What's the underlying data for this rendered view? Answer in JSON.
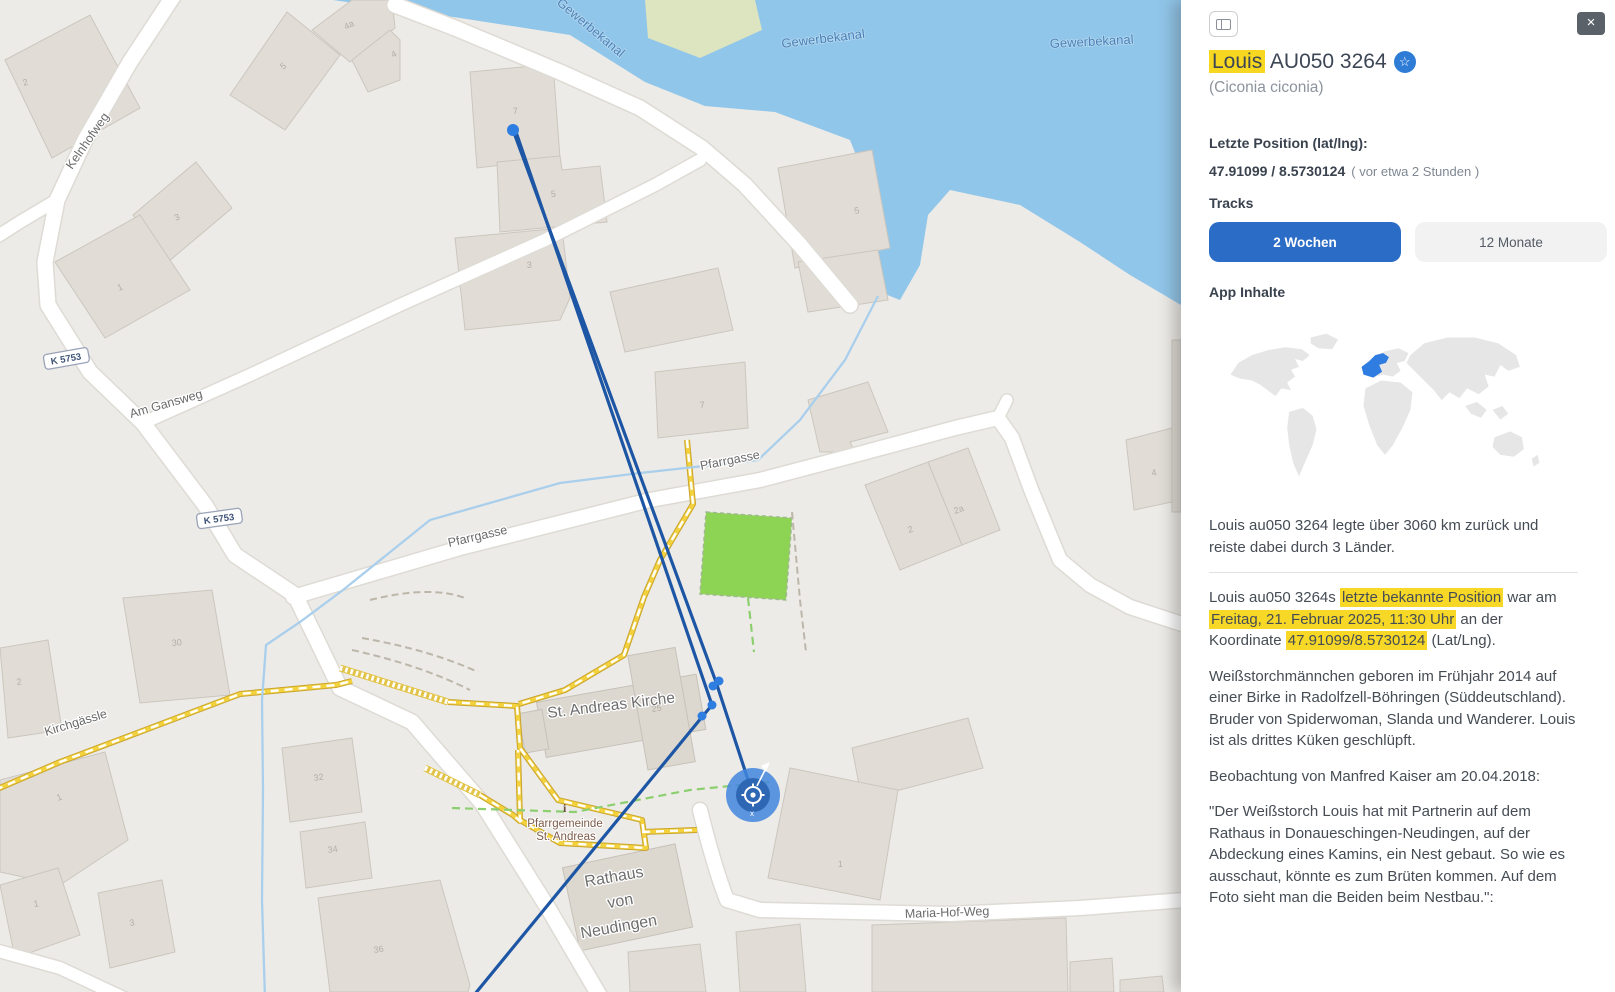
{
  "colors": {
    "accent_blue": "#2b6cc6",
    "highlight_yellow": "#f7d827",
    "track_blue": "#1d56a4",
    "water_blue": "#90c6ea"
  },
  "map": {
    "water_label_1": "Gewerbekanal",
    "water_label_2": "Gewerbekanal",
    "water_label_3": "Gewerbekanal",
    "street": {
      "kelnhofweg": "Kelnhofweg",
      "am_gansweg": "Am Gansweg",
      "pfarrgasse_a": "Pfarrgasse",
      "pfarrgasse_b": "Pfarrgasse",
      "kirchgaessle": "Kirchgässle",
      "maria_hof_weg": "Maria-Hof-Weg"
    },
    "ref_k5753_a": "K 5753",
    "ref_k5753_b": "K 5753",
    "poi": {
      "church": "St. Andreas Kirche",
      "rathaus_1": "Rathaus",
      "rathaus_2": "von",
      "rathaus_3": "Neudingen",
      "pfarrgemeinde_1": "Pfarrgemeinde",
      "pfarrgemeinde_2": "St. Andreas",
      "info": "i"
    },
    "nums": [
      "2",
      "5",
      "4a",
      "4",
      "3",
      "1",
      "7",
      "5",
      "3",
      "7",
      "5",
      "2",
      "2a",
      "4",
      "25",
      "30",
      "2",
      "1",
      "1",
      "3",
      "32",
      "34",
      "36",
      "1"
    ],
    "marker_x_label": "x"
  },
  "panel": {
    "title_highlight": "Louis",
    "title_rest": "AU050 3264",
    "favorite_icon": "☆",
    "close_icon": "×",
    "subtitle": "(Ciconia ciconia)",
    "position_label": "Letzte Position (lat/lng):",
    "position_value": "47.91099 / 8.5730124",
    "position_age": "( vor etwa 2 Stunden )",
    "tracks_label": "Tracks",
    "track_buttons": {
      "two_weeks": "2 Wochen",
      "twelve_months": "12 Monate"
    },
    "app_contents_label": "App Inhalte",
    "summary": {
      "p1": "Louis au050 3264 legte über 3060 km zurück und reiste dabei durch 3 Länder.",
      "p2_s1": "Louis au050 3264s ",
      "p2_h1": "letzte bekannte Position",
      "p2_s2": " war am ",
      "p2_h2": "Freitag, 21. Februar 2025, 11:30 Uhr",
      "p2_s3": " an der Koordinate ",
      "p2_h3": "47.91099/8.5730124",
      "p2_s4": " (Lat/Lng).",
      "p3": "Weißstorchmännchen geboren im Frühjahr 2014 auf einer Birke in Radolfzell-Böhringen (Süddeutschland). Bruder von Spiderwoman, Slanda und Wanderer. Louis ist als drittes Küken geschlüpft.",
      "p4": "Beobachtung von Manfred Kaiser am 20.04.2018:",
      "p5": "\"Der Weißstorch Louis hat mit Partnerin auf dem Rathaus in Donaueschingen-Neudingen, auf der Abdeckung eines Kamins, ein Nest gebaut.  So wie es ausschaut, könnte es zum Brüten kommen. Auf dem Foto sieht man die Beiden beim Nestbau.\":"
    }
  }
}
